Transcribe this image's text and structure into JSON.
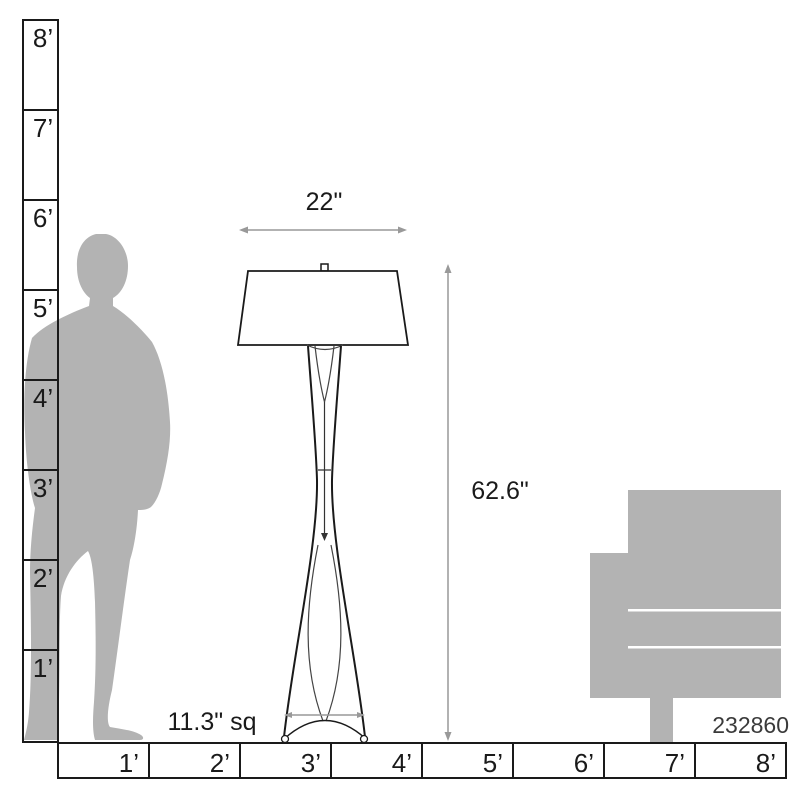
{
  "product_code": "232860",
  "dimension_labels": {
    "shade_width": "22\"",
    "lamp_height": "62.6\"",
    "base_size": "11.3\" sq"
  },
  "vertical_ruler": {
    "labels": [
      "8’",
      "7’",
      "6’",
      "5’",
      "4’",
      "3’",
      "2’",
      "1’"
    ]
  },
  "horizontal_ruler": {
    "labels": [
      "1’",
      "2’",
      "3’",
      "4’",
      "5’",
      "6’",
      "7’",
      "8’"
    ]
  },
  "colors": {
    "silhouette_gray": "#b3b3b3",
    "line_black": "#1a1a1a",
    "dimension_gray": "#999999",
    "code_gray": "#3a3a3a"
  }
}
